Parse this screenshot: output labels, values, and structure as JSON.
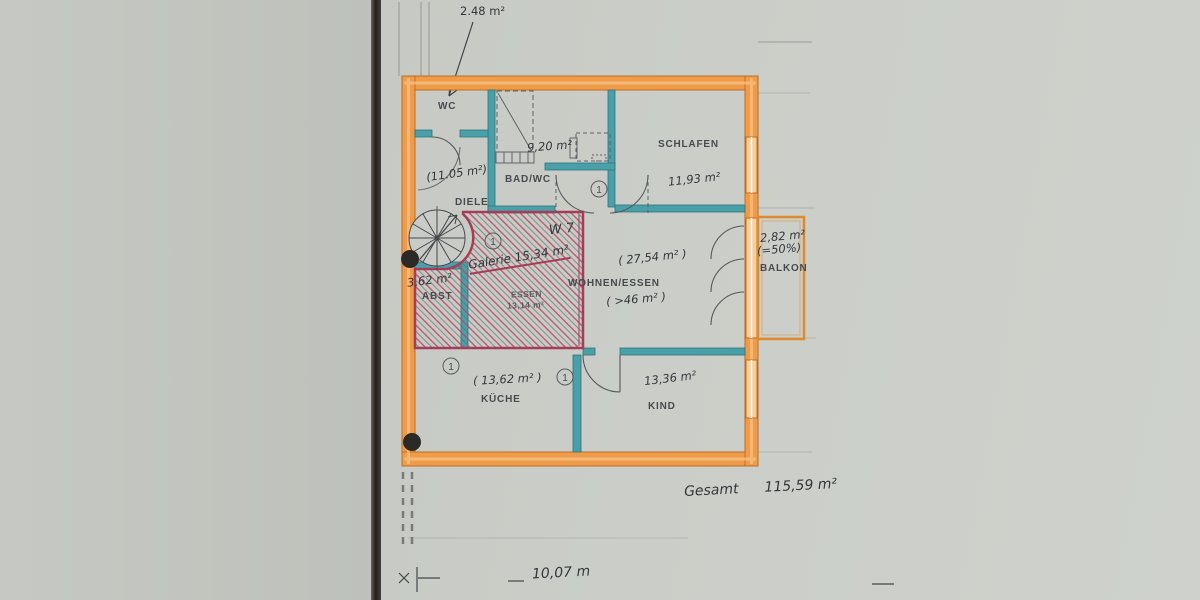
{
  "plan": {
    "rooms": [
      {
        "id": "wc",
        "label": "WC",
        "area": ""
      },
      {
        "id": "bad-wc",
        "label": "BAD/WC",
        "area": "9,20 m²"
      },
      {
        "id": "schlafen",
        "label": "SCHLAFEN",
        "area": "11,93 m²"
      },
      {
        "id": "diele",
        "label": "DIELE",
        "area": "(11.05 m²)"
      },
      {
        "id": "balkon",
        "label": "BALKON",
        "area": "2,82 m²",
        "area_note": "(=50%)"
      },
      {
        "id": "wohnen-essen",
        "label": "WOHNEN/ESSEN",
        "area": "( 27,54 m² )",
        "area_note": "( >46 m² )"
      },
      {
        "id": "essen",
        "label": "ESSEN",
        "area": "13,14 m²"
      },
      {
        "id": "abst",
        "label": "ABST",
        "area": "3,62 m²"
      },
      {
        "id": "kueche",
        "label": "KÜCHE",
        "area": "( 13,62 m² )"
      },
      {
        "id": "kind",
        "label": "KIND",
        "area": "13,36 m²"
      }
    ],
    "annotations": {
      "top_area": "2.48 m²",
      "unit_note": "W 7",
      "galerie_note": "Galerie 15,34 m²",
      "total_label": "Gesamt",
      "total_value": "115,59 m²",
      "width_dimension": "10,07 m",
      "door_marker": "1"
    },
    "colors": {
      "exterior_wall": "#ee9c4b",
      "interior_wall": "#4aa0a8",
      "hatch_border": "#a63d58",
      "paper": "#c7cac4"
    }
  }
}
